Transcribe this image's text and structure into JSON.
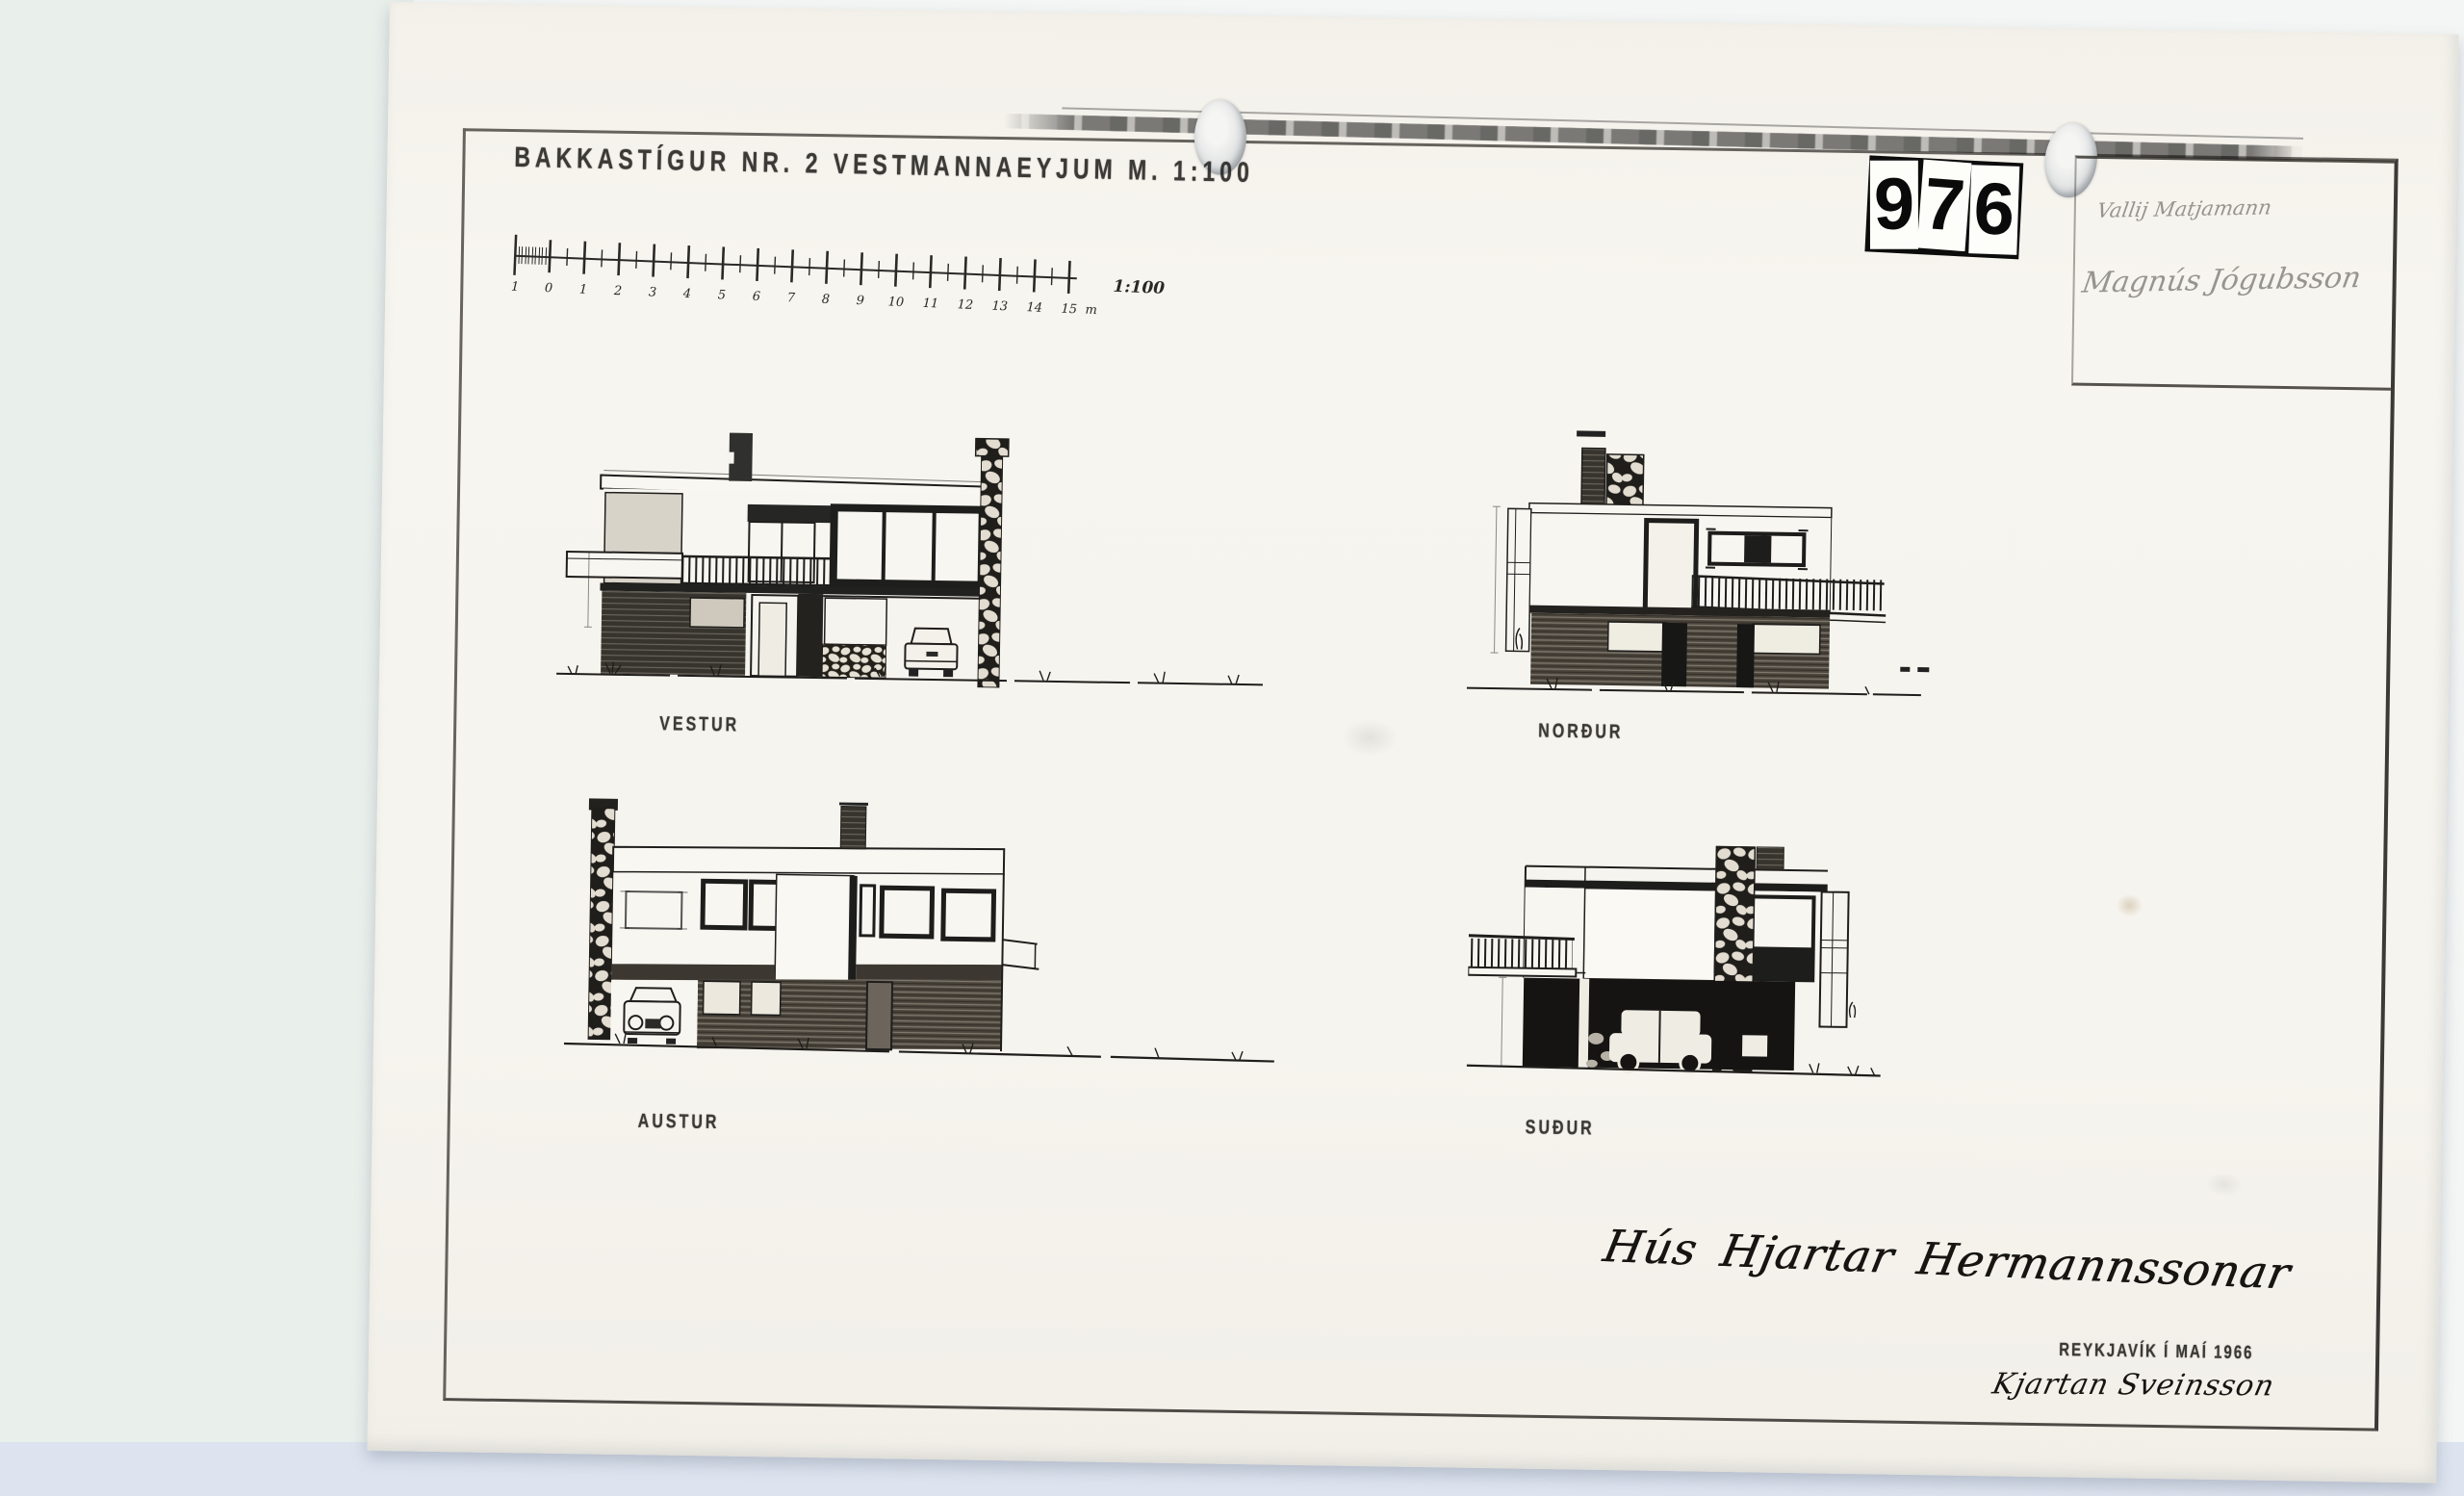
{
  "document": {
    "title": "BAKKASTÍGUR NR. 2 VESTMANNAEYJUM  M. 1:100",
    "archive_stamp": {
      "digits": [
        "9",
        "7",
        "6"
      ]
    },
    "scale_bar": {
      "tick_labels": [
        "1",
        "0",
        "1",
        "2",
        "3",
        "4",
        "5",
        "6",
        "7",
        "8",
        "9",
        "10",
        "11",
        "12",
        "13",
        "14",
        "15"
      ],
      "unit_label": "m",
      "ratio_label": "1:100"
    },
    "title_block": {
      "line1": "Vallij Matjamann",
      "line2": "Magnús Jógubsson"
    },
    "elevations": [
      {
        "label": "VESTUR"
      },
      {
        "label": "NORÐUR"
      },
      {
        "label": "AUSTUR"
      },
      {
        "label": "SUÐUR"
      }
    ],
    "footer": {
      "handwritten_title": "Hús Hjartar Hermannssonar",
      "place_date": "REYKJAVÍK Í MAÍ 1966",
      "signature": "Kjartan Sveinsson"
    }
  },
  "colors": {
    "paper": "#f6f4ee",
    "ink": "#1f1e1c",
    "pencil_gray": "#6f6c66",
    "background_left": "#e9efeb",
    "background_bottom": "#dde4ef"
  }
}
